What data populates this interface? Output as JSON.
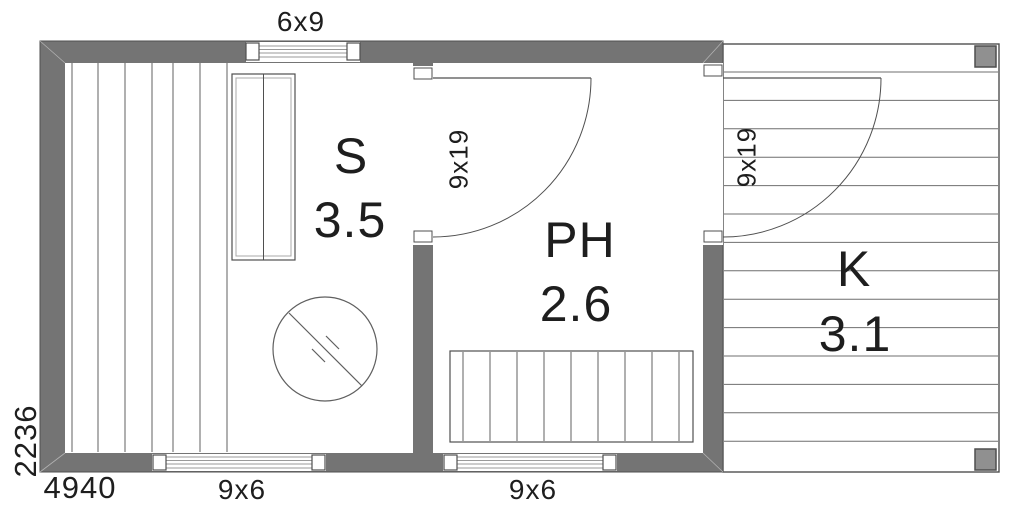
{
  "rooms": [
    {
      "code": "S",
      "area": "3.5",
      "name": "sauna"
    },
    {
      "code": "PH",
      "area": "2.6",
      "name": "washroom"
    },
    {
      "code": "K",
      "area": "3.1",
      "name": "terrace"
    }
  ],
  "dimensions": {
    "overall_width": "4940",
    "overall_depth": "2236"
  },
  "openings": {
    "top_window": "6x9",
    "bottom_window_left": "9x6",
    "bottom_window_right": "9x6",
    "door_sauna": "9x19",
    "door_terrace": "9x19"
  },
  "colors": {
    "wall": "#747474",
    "outline": "#4f4f4f",
    "post": "#909090",
    "plank_line": "#606060",
    "text": "#1e1e1e"
  }
}
